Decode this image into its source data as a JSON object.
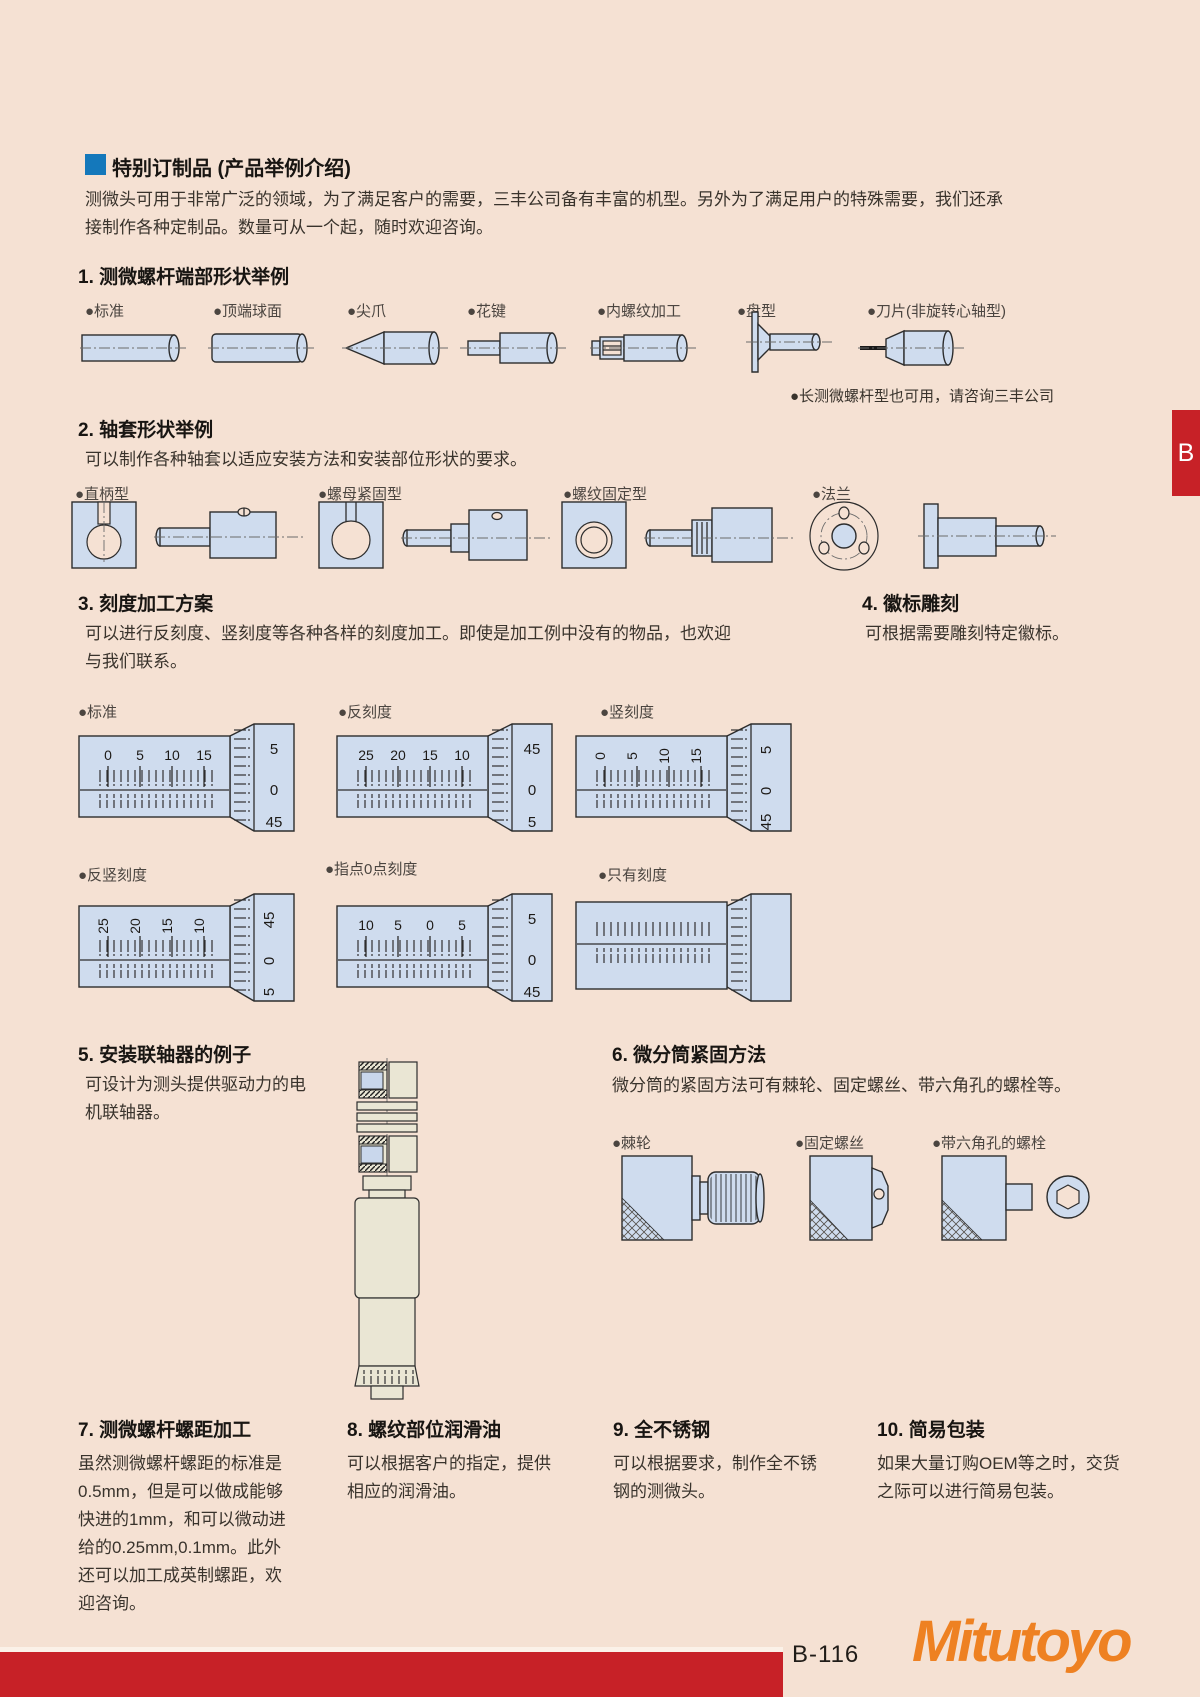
{
  "header": {
    "title": "特别订制品 (产品举例介绍)",
    "intro1": "测微头可用于非常广泛的领域，为了满足客户的需要，三丰公司备有丰富的机型。另外为了满足用户的特殊需要，我们还承",
    "intro2": "接制作各种定制品。数量可从一个起，随时欢迎咨询。"
  },
  "s1": {
    "title": "1. 测微螺杆端部形状举例",
    "labels": [
      "●标准",
      "●顶端球面",
      "●尖爪",
      "●花键",
      "●内螺纹加工",
      "●盘型",
      "●刀片(非旋转心轴型)"
    ],
    "note": "●长测微螺杆型也可用，请咨询三丰公司"
  },
  "s2": {
    "title": "2. 轴套形状举例",
    "desc": "可以制作各种轴套以适应安装方法和安装部位形状的要求。",
    "labels": [
      "●直柄型",
      "●螺母紧固型",
      "●螺纹固定型",
      "●法兰"
    ]
  },
  "s3": {
    "title": "3. 刻度加工方案",
    "desc1": "可以进行反刻度、竖刻度等各种各样的刻度加工。即使是加工例中没有的物品，也欢迎",
    "desc2": "与我们联系。",
    "labels": [
      "●标准",
      "●反刻度",
      "●竖刻度",
      "●反竖刻度",
      "●指点0点刻度",
      "●只有刻度"
    ]
  },
  "s4": {
    "title": "4. 徽标雕刻",
    "desc": "可根据需要雕刻特定徽标。"
  },
  "s5": {
    "title": "5. 安装联轴器的例子",
    "desc1": "可设计为测头提供驱动力的电",
    "desc2": "机联轴器。"
  },
  "s6": {
    "title": "6. 微分筒紧固方法",
    "desc": "微分筒的紧固方法可有棘轮、固定螺丝、带六角孔的螺栓等。",
    "labels": [
      "●棘轮",
      "●固定螺丝",
      "●带六角孔的螺栓"
    ]
  },
  "s7": {
    "title": "7. 测微螺杆螺距加工",
    "lines": [
      "虽然测微螺杆螺距的标准是",
      "0.5mm，但是可以做成能够",
      "快进的1mm，和可以微动进",
      "给的0.25mm,0.1mm。此外",
      "还可以加工成英制螺距，欢",
      "迎咨询。"
    ]
  },
  "s8": {
    "title": "8. 螺纹部位润滑油",
    "lines": [
      "可以根据客户的指定，提供",
      "相应的润滑油。"
    ]
  },
  "s9": {
    "title": "9. 全不锈钢",
    "lines": [
      "可以根据要求，制作全不锈",
      "钢的测微头。"
    ]
  },
  "s10": {
    "title": "10. 简易包装",
    "lines": [
      "如果大量订购OEM等之时，交货",
      "之际可以进行简易包装。"
    ]
  },
  "mics": [
    {
      "name": "标准",
      "sleeve": [
        "0",
        "5",
        "10",
        "15"
      ],
      "thimble": [
        "5",
        "0",
        "45"
      ]
    },
    {
      "name": "反刻度",
      "sleeve": [
        "25",
        "20",
        "15",
        "10"
      ],
      "thimble": [
        "45",
        "0",
        "5"
      ]
    },
    {
      "name": "竖刻度",
      "sleeve": [
        "0",
        "5",
        "10",
        "15"
      ],
      "thimble": [
        "5",
        "0",
        "45"
      ]
    },
    {
      "name": "反竖刻度",
      "sleeve": [
        "25",
        "20",
        "15",
        "10"
      ],
      "thimble": [
        "45",
        "0",
        "5"
      ]
    },
    {
      "name": "指点0点刻度",
      "sleeve": [
        "10",
        "5",
        "0",
        "5"
      ],
      "thimble": [
        "5",
        "0",
        "45"
      ]
    },
    {
      "name": "只有刻度",
      "sleeve": [],
      "thimble": []
    }
  ],
  "footer": {
    "code": "B-116",
    "brand": "Mitutoyo",
    "tab": "B"
  },
  "colors": {
    "bg": "#f5e1d3",
    "accent_red": "#c72127",
    "brand_orange": "#ee8122",
    "header_blue": "#1478bb",
    "part_blue": "#cfdcee",
    "part_beige": "#eae6d4"
  }
}
